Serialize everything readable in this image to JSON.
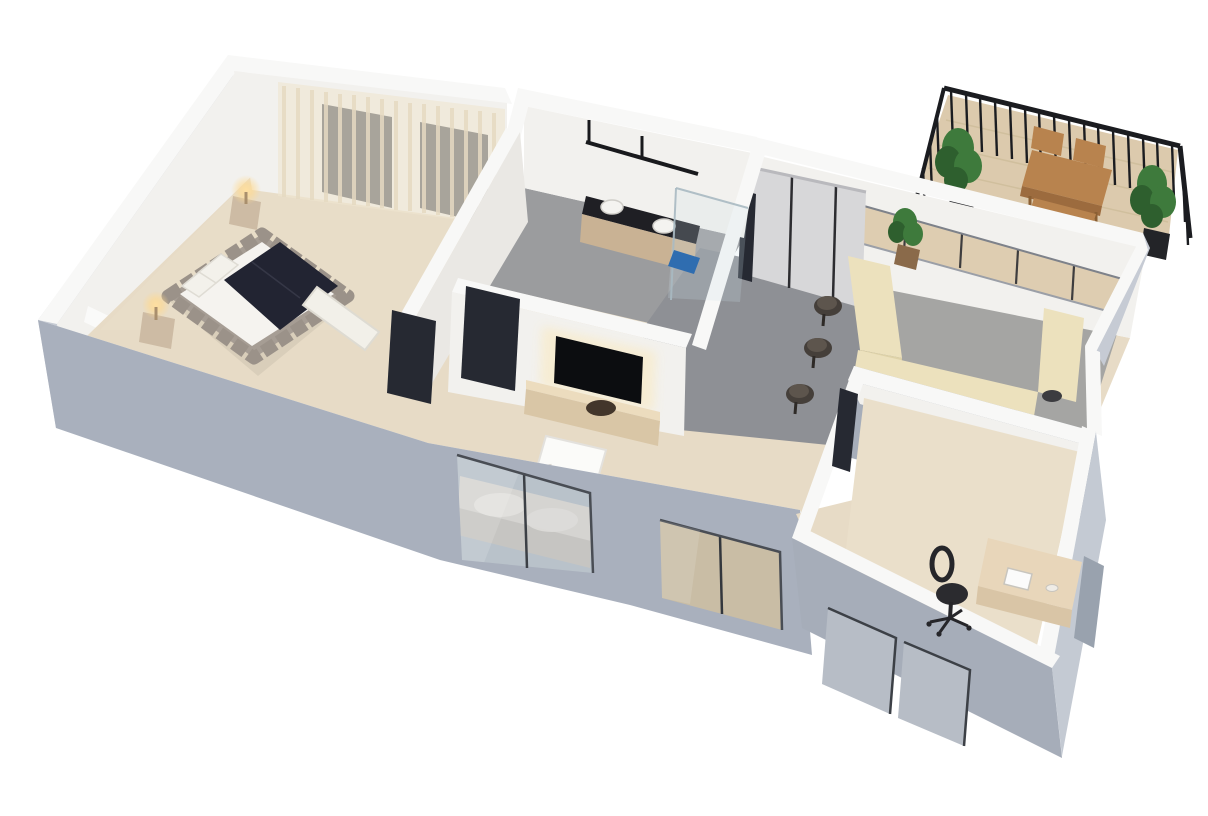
{
  "meta": {
    "kind": "3d-floor-plan-render",
    "style": "isometric dollhouse cutaway, white background, no text",
    "canvas": {
      "width": 1208,
      "height": 816
    }
  },
  "colors": {
    "bg": "#ffffff",
    "wall_top": "#f8f8f7",
    "wall_inner": "#f2f1ee",
    "wall_inner_shade": "#eae8e4",
    "ext_wall_front": "#a9b0bd",
    "ext_wall_side": "#c6cbd4",
    "ext_wall_office": "#a6adb9",
    "ext_wall_office_e": "#c4cad3",
    "wood_floor": "#e7dbc6",
    "wood_floor_warm": "#eadfca",
    "tile_gray": "#9b9c9e",
    "tile_gray_light": "#a5a5a3",
    "carpet_gray": "#8e9095",
    "door_dark": "#262932",
    "window_slab": "#363b44",
    "glass_blue": "#b9c2ca",
    "glass_tan": "#c9bda5",
    "curtain": "#efe5d1",
    "curtain_stripe": "#e3d6ba",
    "bed_frame": "#a69d94",
    "bed_frame_dark": "#968d84",
    "bed_duvet": "#f5f3ef",
    "bed_blanket": "#222432",
    "bench_white": "#f2f0e9",
    "nightstand": "#cdbba4",
    "lamp_glow": "#ffd98f",
    "tv_black": "#0c0d10",
    "tv_glow": "#f7ecd0",
    "console_wood": "#d9c6a6",
    "console_top": "#ecdcbe",
    "speaker_brown": "#43362b",
    "vanity_dark": "#1f1f24",
    "vanity_wood": "#c9b294",
    "mat_blue": "#2f6db0",
    "counter_cream": "#ece1bd",
    "counter_face": "#ded2a8",
    "cabinet_panel": "#d7d7d9",
    "stool_dark": "#453f3a",
    "stool_top": "#5d554d",
    "deck_wood": "#dccaad",
    "railing_black": "#1b1c20",
    "plant_green": "#3e7a3c",
    "plant_green_dark": "#2e5f2e",
    "pot_dark": "#232428",
    "patio_wood": "#b8834e",
    "patio_wood_dark": "#9c6b3e",
    "desk_wood": "#e8d6ba",
    "chair_black": "#2b2b2f",
    "frame_dark": "#41454c",
    "sofa_gray": "#d5d4d1",
    "sofa_gray_dark": "#c6c5c2"
  },
  "scene": {
    "rooms": [
      {
        "id": "bedroom",
        "floor": "light-wood",
        "furniture": [
          "upholstered-double-bed",
          "white-duvet",
          "dark-navy-blanket",
          "two-pillows",
          "two-nightstands",
          "two-lit-table-lamps",
          "white-foot-bench",
          "sheer-curtains",
          "two-dark-framed-windows",
          "black-door"
        ]
      },
      {
        "id": "bathroom",
        "floor": "gray-tile",
        "furniture": [
          "double-vanity",
          "two-white-vessel-sinks",
          "black-wall-mirror-rail",
          "glass-shower-screen",
          "blue-bath-mat",
          "black-door"
        ]
      },
      {
        "id": "living-room",
        "floor": "light-wood",
        "furniture": [
          "wall-mounted-tv-with-backlight",
          "wood-tv-console",
          "round-speaker",
          "white-coffee-table",
          "gray-sofa-at-window",
          "sliding-glass-door"
        ]
      },
      {
        "id": "dining-area",
        "floor": "gray-carpet",
        "furniture": [
          "tall-wardrobe-cabinets",
          "four-dark-bar-stools"
        ]
      },
      {
        "id": "kitchen",
        "floor": "gray-tile",
        "furniture": [
          "u-shaped-cream-counter",
          "dark-cooktop",
          "white-sink",
          "window-wall-to-balcony",
          "potted-plant"
        ]
      },
      {
        "id": "office",
        "floor": "light-wood",
        "furniture": [
          "wood-desk",
          "black-office-chair",
          "white-laptop",
          "two-front-windows",
          "side-window",
          "dark-doorway"
        ]
      },
      {
        "id": "balcony",
        "floor": "wood-deck",
        "furniture": [
          "black-metal-railing",
          "wood-outdoor-table",
          "two-wood-chairs",
          "wood-bench",
          "two-potted-palms"
        ]
      }
    ]
  }
}
